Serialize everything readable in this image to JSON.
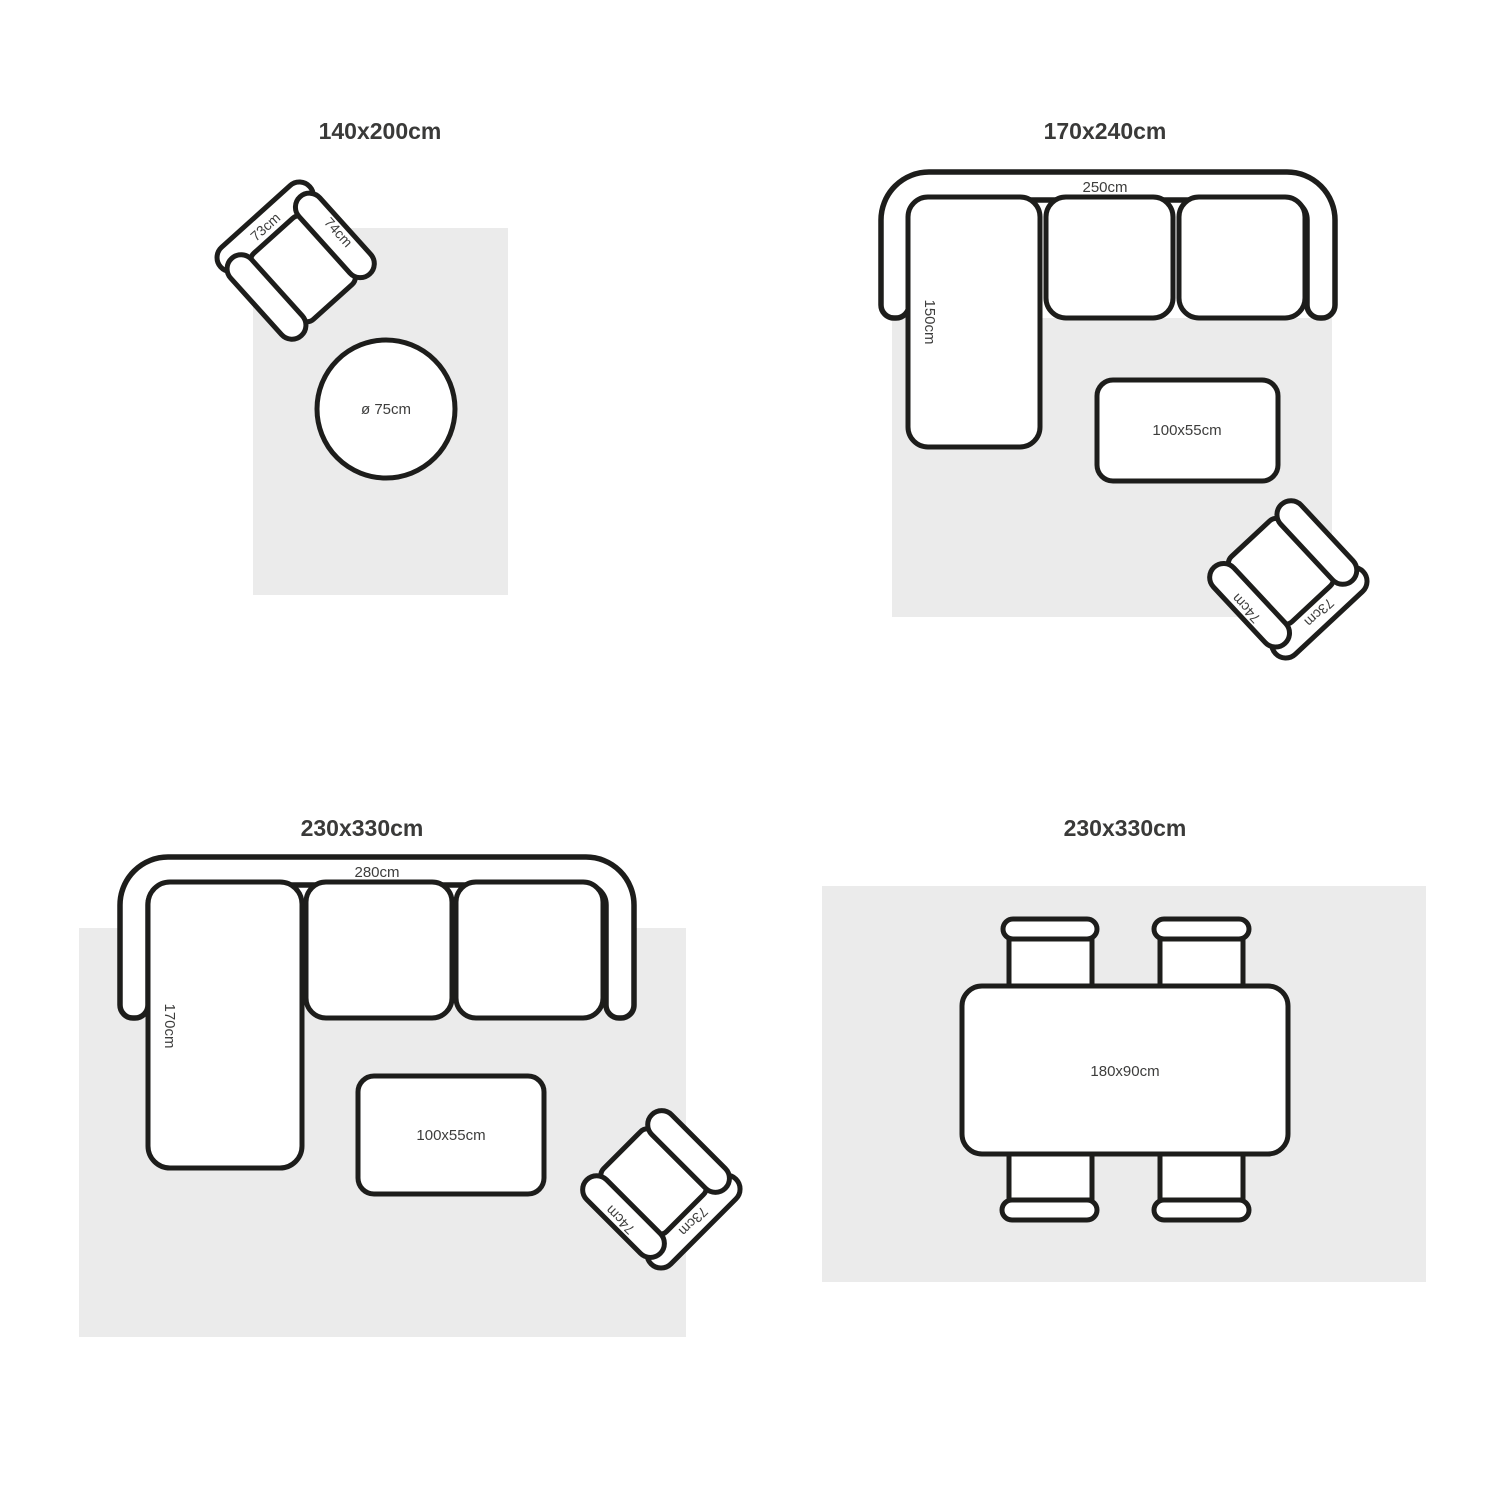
{
  "colors": {
    "outline": "#1d1d1b",
    "rug": "#ebebeb",
    "text": "#3d3d3c",
    "title_text": "#3a3a39",
    "background": "#ffffff"
  },
  "panels": [
    {
      "title": "140x200cm",
      "armchair": {
        "back_label": "73cm",
        "arm_label": "74cm"
      },
      "round_table": {
        "label": "ø 75cm"
      }
    },
    {
      "title": "170x240cm",
      "sofa": {
        "width_label": "250cm",
        "depth_label": "150cm"
      },
      "coffee_table": {
        "label": "100x55cm"
      },
      "armchair": {
        "back_label": "73cm",
        "arm_label": "74cm"
      }
    },
    {
      "title": "230x330cm",
      "sofa": {
        "width_label": "280cm",
        "depth_label": "170cm"
      },
      "coffee_table": {
        "label": "100x55cm"
      },
      "armchair": {
        "back_label": "73cm",
        "arm_label": "74cm"
      }
    },
    {
      "title": "230x330cm",
      "dining_table": {
        "label": "180x90cm"
      }
    }
  ]
}
